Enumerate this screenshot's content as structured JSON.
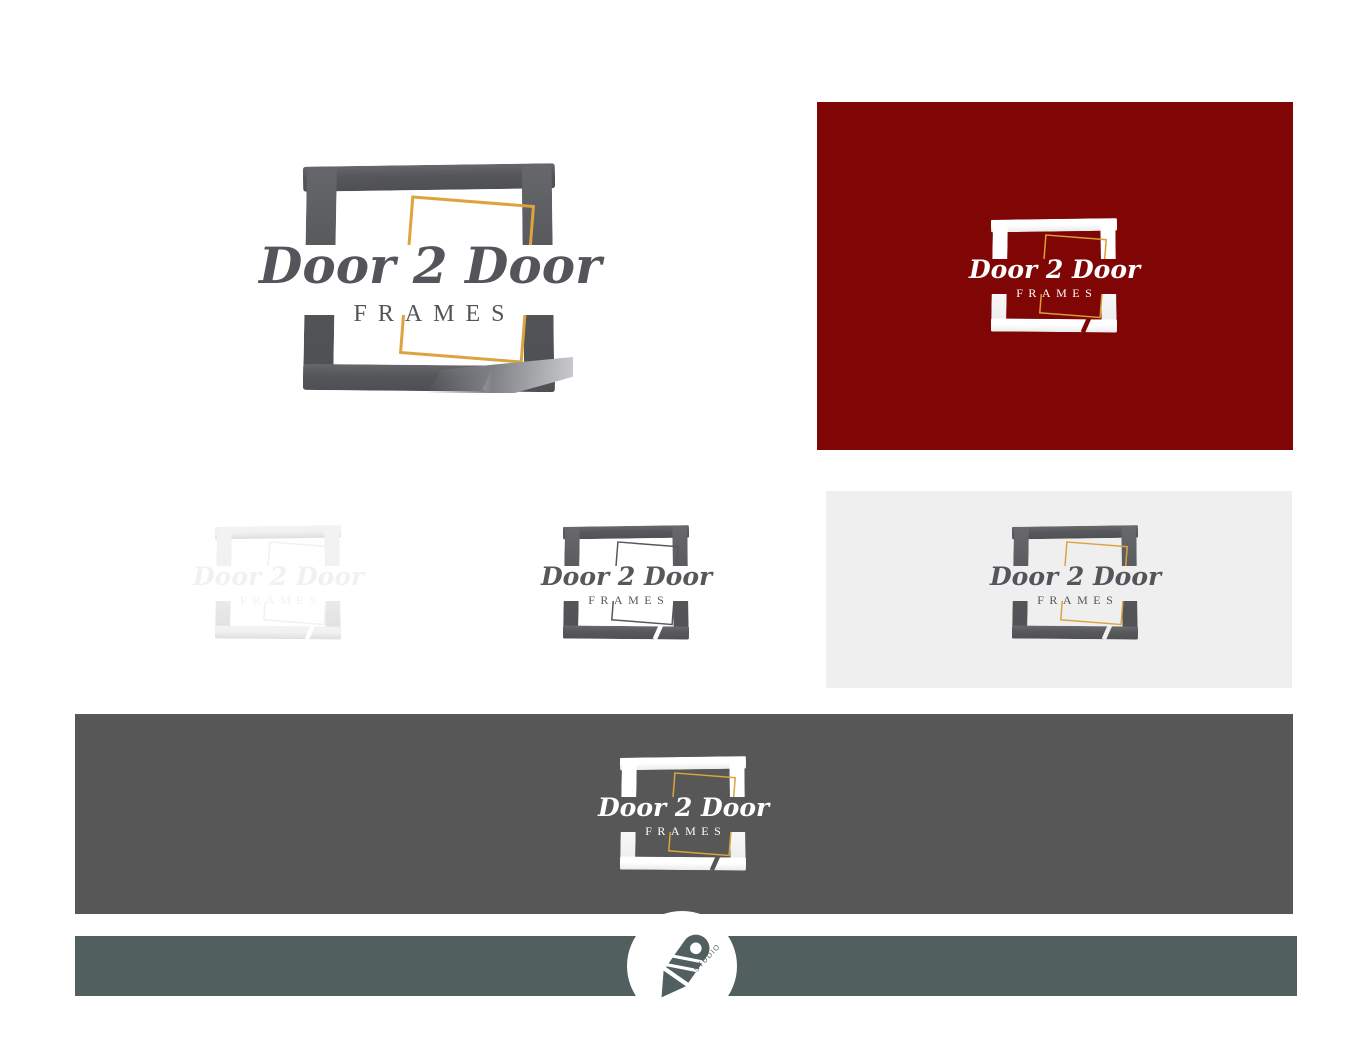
{
  "logo": {
    "script_text": "Door 2 Door",
    "sub_text": "FRAMES",
    "variants": {
      "hero": {
        "frame": "#55565a",
        "accent": "#dda43e",
        "text": "#54555a",
        "band": "#ffffff"
      },
      "on_maroon": {
        "frame": "#ffffff",
        "accent": "#d99f35",
        "text": "#ffffff",
        "band": "#800606"
      },
      "faint": {
        "frame": "#f2f1f1",
        "accent": "#f2f1f1",
        "text": "#f2f1f1",
        "band": "#ffffff"
      },
      "mono": {
        "frame": "#58585c",
        "accent": "#58585c",
        "text": "#58585c",
        "band": "#ffffff"
      },
      "on_light": {
        "frame": "#57585c",
        "accent": "#dda43e",
        "text": "#54555a",
        "band": "#f0efef"
      },
      "on_dark": {
        "frame": "#ffffff",
        "accent": "#dda43e",
        "text": "#ffffff",
        "band": "#575757"
      },
      "footer_badge": {
        "frame": "#525f5f"
      }
    }
  },
  "panels": {
    "page_bg": "#ffffff",
    "maroon_bg": "#800606",
    "light_bg": "#f0efef",
    "dark_banner_bg": "#575757",
    "footer_bar_bg": "#525f5f",
    "badge_bg": "#ffffff"
  },
  "footer": {
    "studio_label": "STUDIO"
  }
}
